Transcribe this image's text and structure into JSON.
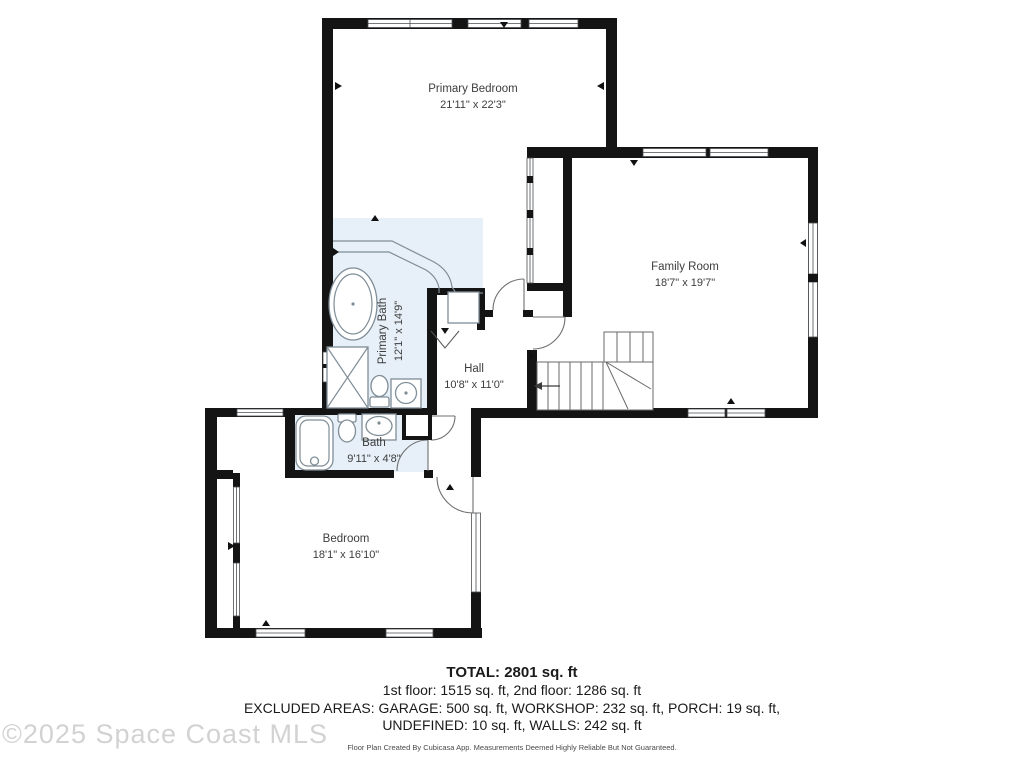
{
  "rooms": [
    {
      "name": "Primary Bedroom",
      "dims": "21'11\" x 22'3\""
    },
    {
      "name": "Family Room",
      "dims": "18'7\" x 19'7\""
    },
    {
      "name": "Primary Bath",
      "dims": "12'1\" x 14'9\""
    },
    {
      "name": "Hall",
      "dims": "10'8\" x 11'0\""
    },
    {
      "name": "Bath",
      "dims": "9'11\" x 4'8\""
    },
    {
      "name": "Bedroom",
      "dims": "18'1\" x 16'10\""
    }
  ],
  "summary": {
    "total": "TOTAL: 2801 sq. ft",
    "floors": "1st floor: 1515 sq. ft, 2nd floor: 1286 sq. ft",
    "excluded_1": "EXCLUDED AREAS: GARAGE: 500 sq. ft, WORKSHOP: 232 sq. ft, PORCH: 19 sq. ft,",
    "excluded_2": "UNDEFINED: 10 sq. ft, WALLS: 242 sq. ft",
    "disclaimer": "Floor Plan Created By Cubicasa App. Measurements Deemed Highly Reliable But Not Guaranteed."
  },
  "watermark": "©2025 Space Coast MLS",
  "colors": {
    "wall": "#141414",
    "wet_area": "#e7f0f8",
    "fixture": "#7f8d96"
  }
}
